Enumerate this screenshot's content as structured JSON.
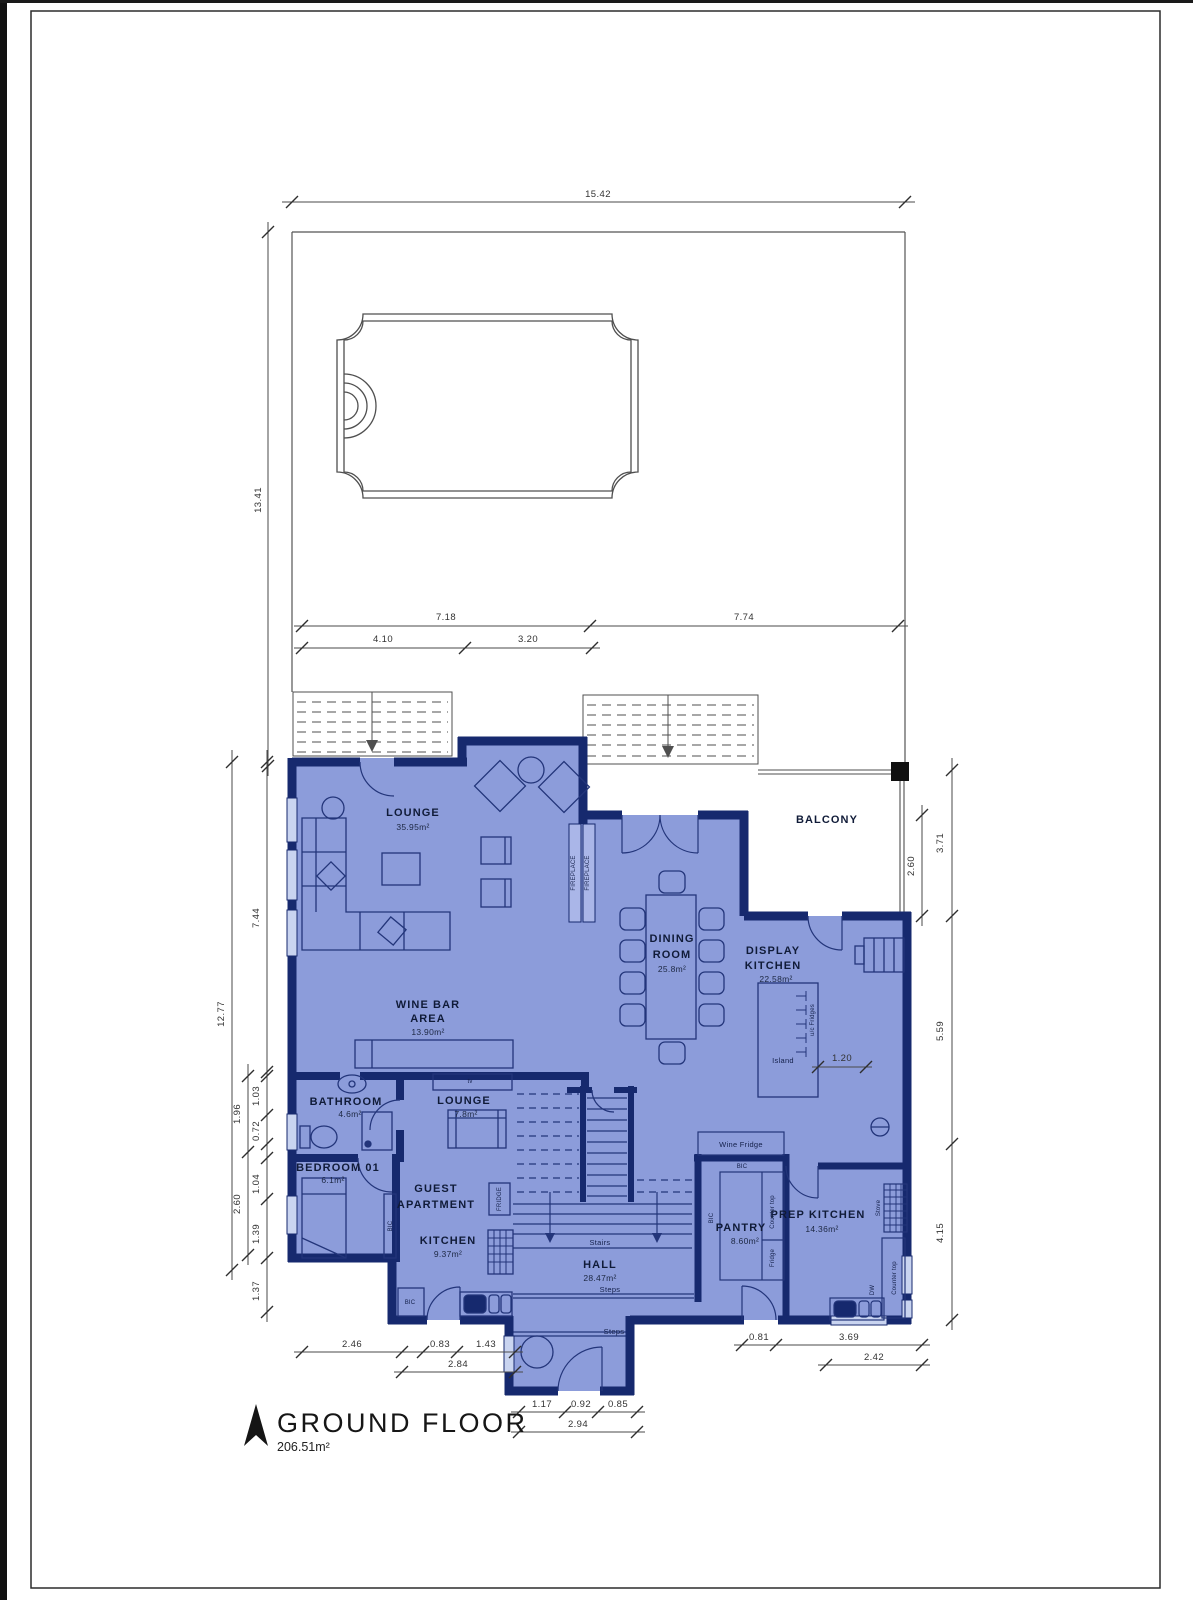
{
  "plan": {
    "title": "GROUND FLOOR",
    "total_area": "206.51m²",
    "rooms": {
      "lounge": {
        "name": "LOUNGE",
        "area": "35.95m²"
      },
      "wine_bar": {
        "name_line1": "WINE BAR",
        "name_line2": "AREA",
        "area": "13.90m²"
      },
      "dining": {
        "name_line1": "DINING",
        "name_line2": "ROOM",
        "area": "25.8m²"
      },
      "display_kitchen": {
        "name_line1": "DISPLAY",
        "name_line2": "KITCHEN",
        "area": "22.58m²"
      },
      "balcony": {
        "name": "BALCONY"
      },
      "bathroom": {
        "name": "BATHROOM",
        "area": "4.6m²"
      },
      "guest_lounge": {
        "name": "LOUNGE",
        "area": "7.8m²"
      },
      "bedroom": {
        "name": "BEDROOM 01",
        "area": "6.1m²"
      },
      "guest_apartment": {
        "name_line1": "GUEST",
        "name_line2": "APARTMENT"
      },
      "guest_kitchen": {
        "name": "KITCHEN",
        "area": "9.37m²"
      },
      "hall": {
        "name": "HALL",
        "area": "28.47m²"
      },
      "pantry": {
        "name": "PANTRY",
        "area": "8.60m²"
      },
      "prep_kitchen": {
        "name": "PREP KITCHEN",
        "area": "14.36m²"
      }
    },
    "fixtures": {
      "fireplace": "FIREPLACE",
      "tv": "tv",
      "fridge_tall": "FRIDGE",
      "bic": "BIC",
      "wine_fridge": "Wine Fridge",
      "counter_top": "Counter top",
      "fridge": "Fridge",
      "stove": "Stove",
      "dw": "DW",
      "island": "Island",
      "uc_fridges": "u/c Fridges",
      "stairs": "Stairs",
      "steps": "Steps"
    },
    "dimensions": {
      "site_width": "15.42",
      "site_depth": "13.41",
      "top_left": "7.18",
      "top_right": "7.74",
      "top_sub_left": "4.10",
      "top_sub_right": "3.20",
      "left_upper": "7.44",
      "left_total": "12.77",
      "left_a": "1.03",
      "left_b": "1.96",
      "left_c": "0.72",
      "left_d": "1.04",
      "left_e": "2.60",
      "left_f": "1.39",
      "left_g": "1.37",
      "right_balcony_outer": "3.71",
      "right_balcony_inner": "2.60",
      "right_mid": "5.59",
      "right_lower": "4.15",
      "island": "1.20",
      "bottom_left_a": "2.46",
      "bottom_left_b": "0.83",
      "bottom_left_c": "1.43",
      "bottom_left_d": "2.84",
      "bottom_center_a": "1.17",
      "bottom_center_b": "0.92",
      "bottom_center_c": "0.85",
      "bottom_center_d": "2.94",
      "bottom_right_a": "0.81",
      "bottom_right_b": "3.69",
      "bottom_right_c": "2.42"
    },
    "colors": {
      "wall": "#16296e",
      "floor": "#8c9cda",
      "window": "#c9d4f0",
      "line": "#23357a"
    }
  }
}
